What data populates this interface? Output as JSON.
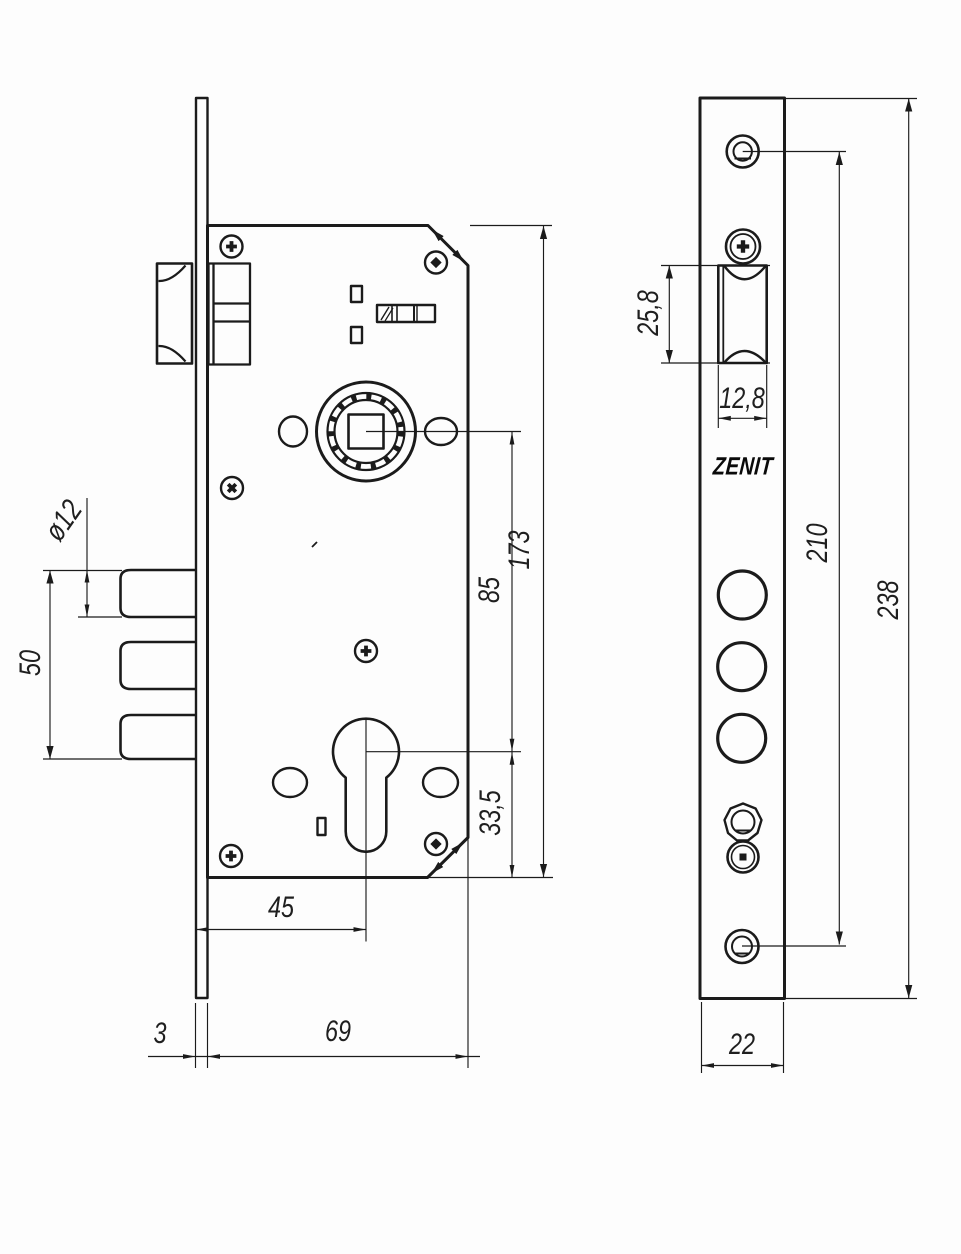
{
  "brand": {
    "logo_text": "ZENIT"
  },
  "dimensions_front_view": {
    "bolt_diameter": "ø12",
    "bolt_group_height": "50",
    "case_height": "173",
    "hub_to_cylinder_center": "85",
    "cylinder_to_bottom_edge": "33,5",
    "backset": "45",
    "faceplate_thickness": "3",
    "case_depth": "69"
  },
  "dimensions_side_view": {
    "latch_cutout_height": "25,8",
    "latch_cutout_width": "12,8",
    "mount_hole_spacing": "210",
    "faceplate_length": "238",
    "faceplate_width": "22"
  }
}
